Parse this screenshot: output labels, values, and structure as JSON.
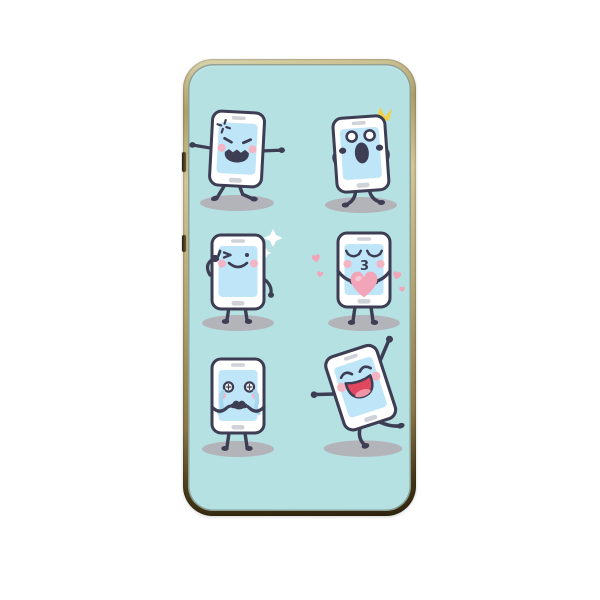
{
  "page": {
    "background_color": "#ffffff"
  },
  "case": {
    "frame_colors": {
      "light": "#ded8b2",
      "mid": "#b3a571",
      "dark": "#453718"
    },
    "interior_color": "#b5e1e2",
    "side_buttons": [
      {
        "name": "upper-side-button"
      },
      {
        "name": "lower-side-button"
      }
    ]
  },
  "pattern": {
    "shadow_color": "#b3b3ba",
    "phone_body_color": "#ffffff",
    "outline_color": "#3d3d54",
    "screen_color": "#bfe6f8",
    "trim_color": "#cfd2d8",
    "cheek_color": "#f3b4c3",
    "tear_color": "#a6d7ee",
    "heart_color": "#f2a4b8",
    "heart_highlight_color": "#f8c6d2",
    "sparkle_color": "#ffffff",
    "crown_color": "#efd04b",
    "mouth_red_color": "#e1475f",
    "tongue_color": "#f294a6",
    "characters": [
      {
        "id": "angry",
        "emotion": "angry",
        "position": "top-left"
      },
      {
        "id": "shocked",
        "emotion": "shocked",
        "position": "top-right"
      },
      {
        "id": "winking",
        "emotion": "winking-thumbs-up",
        "position": "middle-left"
      },
      {
        "id": "kissing",
        "emotion": "blowing-kiss",
        "position": "middle-right",
        "mouth_glyph": "3"
      },
      {
        "id": "crying",
        "emotion": "crying",
        "position": "bottom-left"
      },
      {
        "id": "dancing",
        "emotion": "happy-dancing",
        "position": "bottom-right"
      }
    ]
  }
}
